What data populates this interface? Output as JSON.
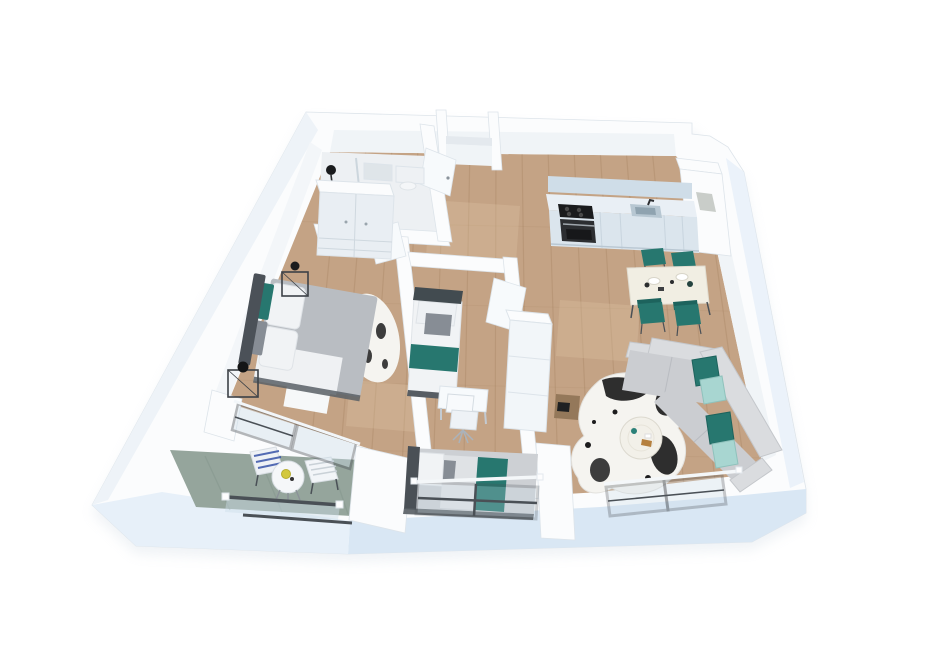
{
  "scene": {
    "title": "3D isometric apartment floor plan render",
    "style": "perspective cutaway, furnished",
    "background": "#ffffff",
    "rooms": [
      {
        "name": "bathroom",
        "position": "top-left",
        "items": [
          "shower-head",
          "wall-fixtures",
          "glass-divider",
          "floor-lamp"
        ]
      },
      {
        "name": "master-bedroom",
        "position": "left",
        "items": [
          "wardrobe",
          "double-bed",
          "teal-headboard-cushions",
          "white-pillows",
          "gray-duvet",
          "wire-nightstand-left",
          "wire-nightstand-right",
          "black-table-lamp",
          "cowhide-rug",
          "sliding-balcony-door"
        ]
      },
      {
        "name": "hallway",
        "position": "center",
        "items": [
          "storage-niche",
          "open-white-doors"
        ]
      },
      {
        "name": "kitchen",
        "position": "top-right",
        "items": [
          "cabinet-run",
          "black-cooktop",
          "oven",
          "sink",
          "faucet",
          "tall-column-with-recess"
        ]
      },
      {
        "name": "dining-area",
        "position": "center-right",
        "items": [
          "white-dining-table",
          "four-teal-chairs",
          "place-settings"
        ]
      },
      {
        "name": "living-room",
        "position": "right",
        "items": [
          "white-sideboard",
          "wood-media-stool",
          "l-shaped-gray-sofa",
          "teal-pillows",
          "aqua-pillows",
          "black-white-cowhide-rug",
          "round-coffee-table",
          "corner-window"
        ]
      },
      {
        "name": "bedroom-2",
        "position": "center-bottom",
        "items": [
          "single-bed-top",
          "white-desk",
          "white-office-chair",
          "single-bed-bottom-teal-runner",
          "front-window"
        ]
      },
      {
        "name": "balcony",
        "position": "bottom-left",
        "items": [
          "stone-floor",
          "round-bistro-table",
          "yellow-accent-item",
          "blue-striped-folding-chair",
          "white-slatted-folding-chair",
          "glass-railing-dark-rails"
        ]
      }
    ],
    "palette": {
      "canvas": "#ffffff",
      "wallTop": "#fbfcfd",
      "wallFace": "#f0f4f7",
      "wallShade": "#e4e9ee",
      "wallStroke": "#dde4ea",
      "blueFace": "#d9e7f4",
      "blueFaceLight": "#e7f0f9",
      "shadow": "#b9c8d6",
      "wood": "#c4a385",
      "woodLine": "#a3815f",
      "woodLight": "#e2c9a8",
      "bathFloor": "#edf0f3",
      "stone": "#95a59c",
      "stoneDark": "#7e9087",
      "frameDark": "#4a5056",
      "glass": "#ccdde8",
      "teal": "#27776f",
      "tealDark": "#1d635d",
      "aqua": "#a8d6d1",
      "sofa": "#cbcdd1",
      "sofaLight": "#dadcdf",
      "bedGray": "#b9bdc2",
      "bedWhite": "#f1f3f5",
      "headboard": "#4b5158",
      "grayCushion": "#878d95",
      "white": "#f7fafc",
      "cream": "#f1eee3",
      "kitchenFront": "#dbe5ed",
      "kitchenTop": "#e9eff5",
      "kitchenUpper": "#cfdde8",
      "black": "#1a1b1d",
      "darkAppliance": "#2c2e31",
      "sinkSteel": "#b7c7d2",
      "cow": "#f5f4f0",
      "cowSpot": "#1c1c1d",
      "woodFurn": "#8f7355",
      "stripeBlue": "#3753a8",
      "yellow": "#d3c83c"
    }
  }
}
